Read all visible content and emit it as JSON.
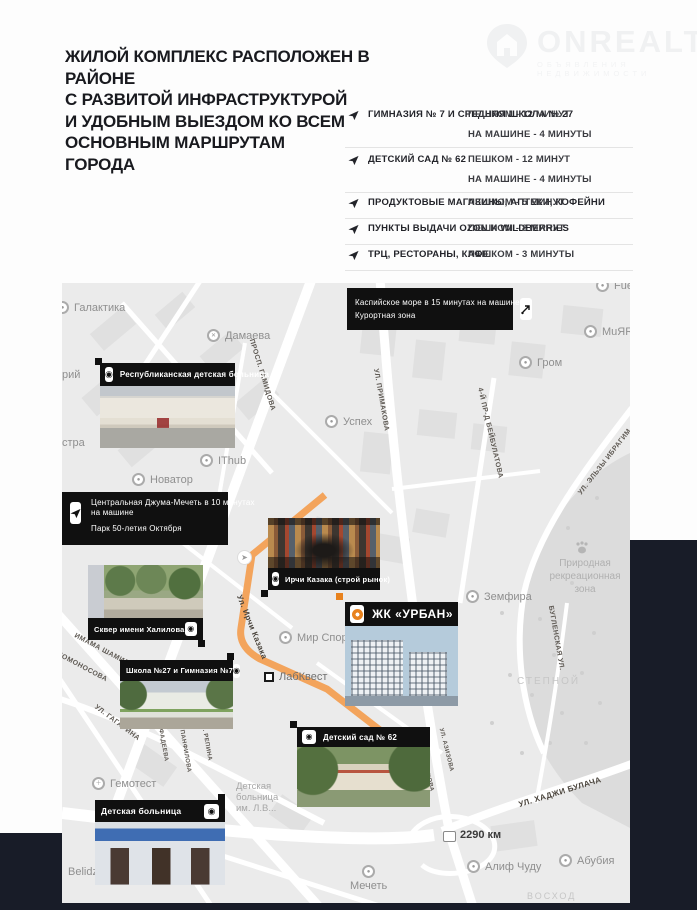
{
  "logo": {
    "name": "ONREALT",
    "tagline": "ОБЪЯВЛЕНИЯ НЕДВИЖИМОСТИ"
  },
  "heading": {
    "lines": [
      "ЖИЛОЙ КОМПЛЕКС РАСПОЛОЖЕН В РАЙОНЕ",
      "С РАЗВИТОЙ ИНФРАСТРУКТУРОЙ",
      "И УДОБНЫМ ВЫЕЗДОМ КО ВСЕМ",
      "ОСНОВНЫМ МАРШРУТАМ",
      "ГОРОДА"
    ]
  },
  "amenities": {
    "rows": [
      {
        "label": "ГИМНАЗИЯ № 7 И СРЕДНЯЯ ШКОЛА № 27",
        "time1": "ПЕШКОМ - 12 МИНУТ",
        "time2": "НА МАШИНЕ - 4 МИНУТЫ"
      },
      {
        "label": "ДЕТСКИЙ САД № 62",
        "time1": "ПЕШКОМ - 12 МИНУТ",
        "time2": "НА МАШИНЕ - 4 МИНУТЫ"
      },
      {
        "label": "ПРОДУКТОВЫЕ МАГАЗИНЫ, АПТЕКИ, КОФЕЙНИ",
        "time1": "ПЕШКОМ - 5 МИНУТ"
      },
      {
        "label": "ПУНКТЫ ВЫДАЧИ OZON И WILDBERRIES",
        "time1": "ПЕШКОМ - 8 МИНУТ"
      },
      {
        "label": "ТРЦ, РЕСТОРАНЫ, КАФЕ",
        "time1": "ПЕШКОМ - 3 МИНУТЫ"
      }
    ]
  },
  "map": {
    "callouts": {
      "sea": {
        "line1": "Каспийское море в 15 минутах на машине",
        "line2": "Курортная зона"
      },
      "mosque": {
        "line1": "Центральная Джума-Мечеть в 10 минутах",
        "line2": "на машине",
        "line3": "Парк 50-летия Октября"
      },
      "rdkb": {
        "label": "Республиканская детская больница"
      },
      "market": {
        "label": "Ирчи Казака (строй рынок)"
      },
      "urban": {
        "label": "ЖК «УРБАН»"
      },
      "skver": {
        "label": "Сквер имени Халилова"
      },
      "school": {
        "label": "Школа №27 и Гимназия №7"
      },
      "detsad": {
        "label": "Детский сад № 62"
      },
      "childhosp": {
        "label": "Детская больница"
      }
    },
    "pois": [
      {
        "label": "Галактика"
      },
      {
        "label": "Дамаева"
      },
      {
        "label": "Успех"
      },
      {
        "label": "IThub"
      },
      {
        "label": "Новатор"
      },
      {
        "label": "Мир Спорта"
      },
      {
        "label": "ЛабКвест"
      },
      {
        "label": "Земфира"
      },
      {
        "label": "Гром"
      },
      {
        "label": "MuЯRad"
      },
      {
        "label": "Fuel"
      },
      {
        "label": "Гемотест"
      },
      {
        "label": "Мечеть"
      },
      {
        "label": "Алиф Чуду"
      },
      {
        "label": "Абубия"
      }
    ],
    "streets": [
      {
        "name": "ПРОСП. ГАМИДОВА"
      },
      {
        "name": "УЛ. ПРИМАКОВА"
      },
      {
        "name": "4-Й ПР-Д БЕЙБУЛАТОВА"
      },
      {
        "name": "УЛ. ЭЛЬЗЫ ИБРАГИМ"
      },
      {
        "name": "БУГЛЕНСКАЯ УЛ."
      },
      {
        "name": "Ул. Ирчи Казака"
      },
      {
        "name": "ИМАМА ШАМИЛЯ"
      },
      {
        "name": "ЛОМОНОСОВА"
      },
      {
        "name": "УЛ. ГАГАРИНА"
      },
      {
        "name": "УЛ. ФАДЕЕВА"
      },
      {
        "name": "УЛ. ПАНФИЛОВА"
      },
      {
        "name": "УЛ. РЕПИНА"
      },
      {
        "name": "УЛ. ХАДЖИ БУЛАЧА"
      },
      {
        "name": "УЛ. ПРИМАКОВА"
      },
      {
        "name": "УЛ. АЗИЗОВА"
      }
    ],
    "areas": {
      "stepnoy": "СТЕПНОЙ",
      "voskhod": "ВОСХОД",
      "nature1": "Природная",
      "nature2": "рекреационная",
      "nature3": "зона",
      "hosp1": "Детская",
      "hosp2": "больница",
      "hosp3": "им. Л.В...",
      "partial_riy": "рий",
      "partial_stra": "стра",
      "belidzhi": "Belidzh",
      "km_marker": "2290 км"
    }
  },
  "colors": {
    "navy": "#181c28",
    "callout_black": "#101010",
    "accent_orange": "#e8821e",
    "road_orange": "#f3a45c",
    "map_bg": "#ebebeb"
  }
}
